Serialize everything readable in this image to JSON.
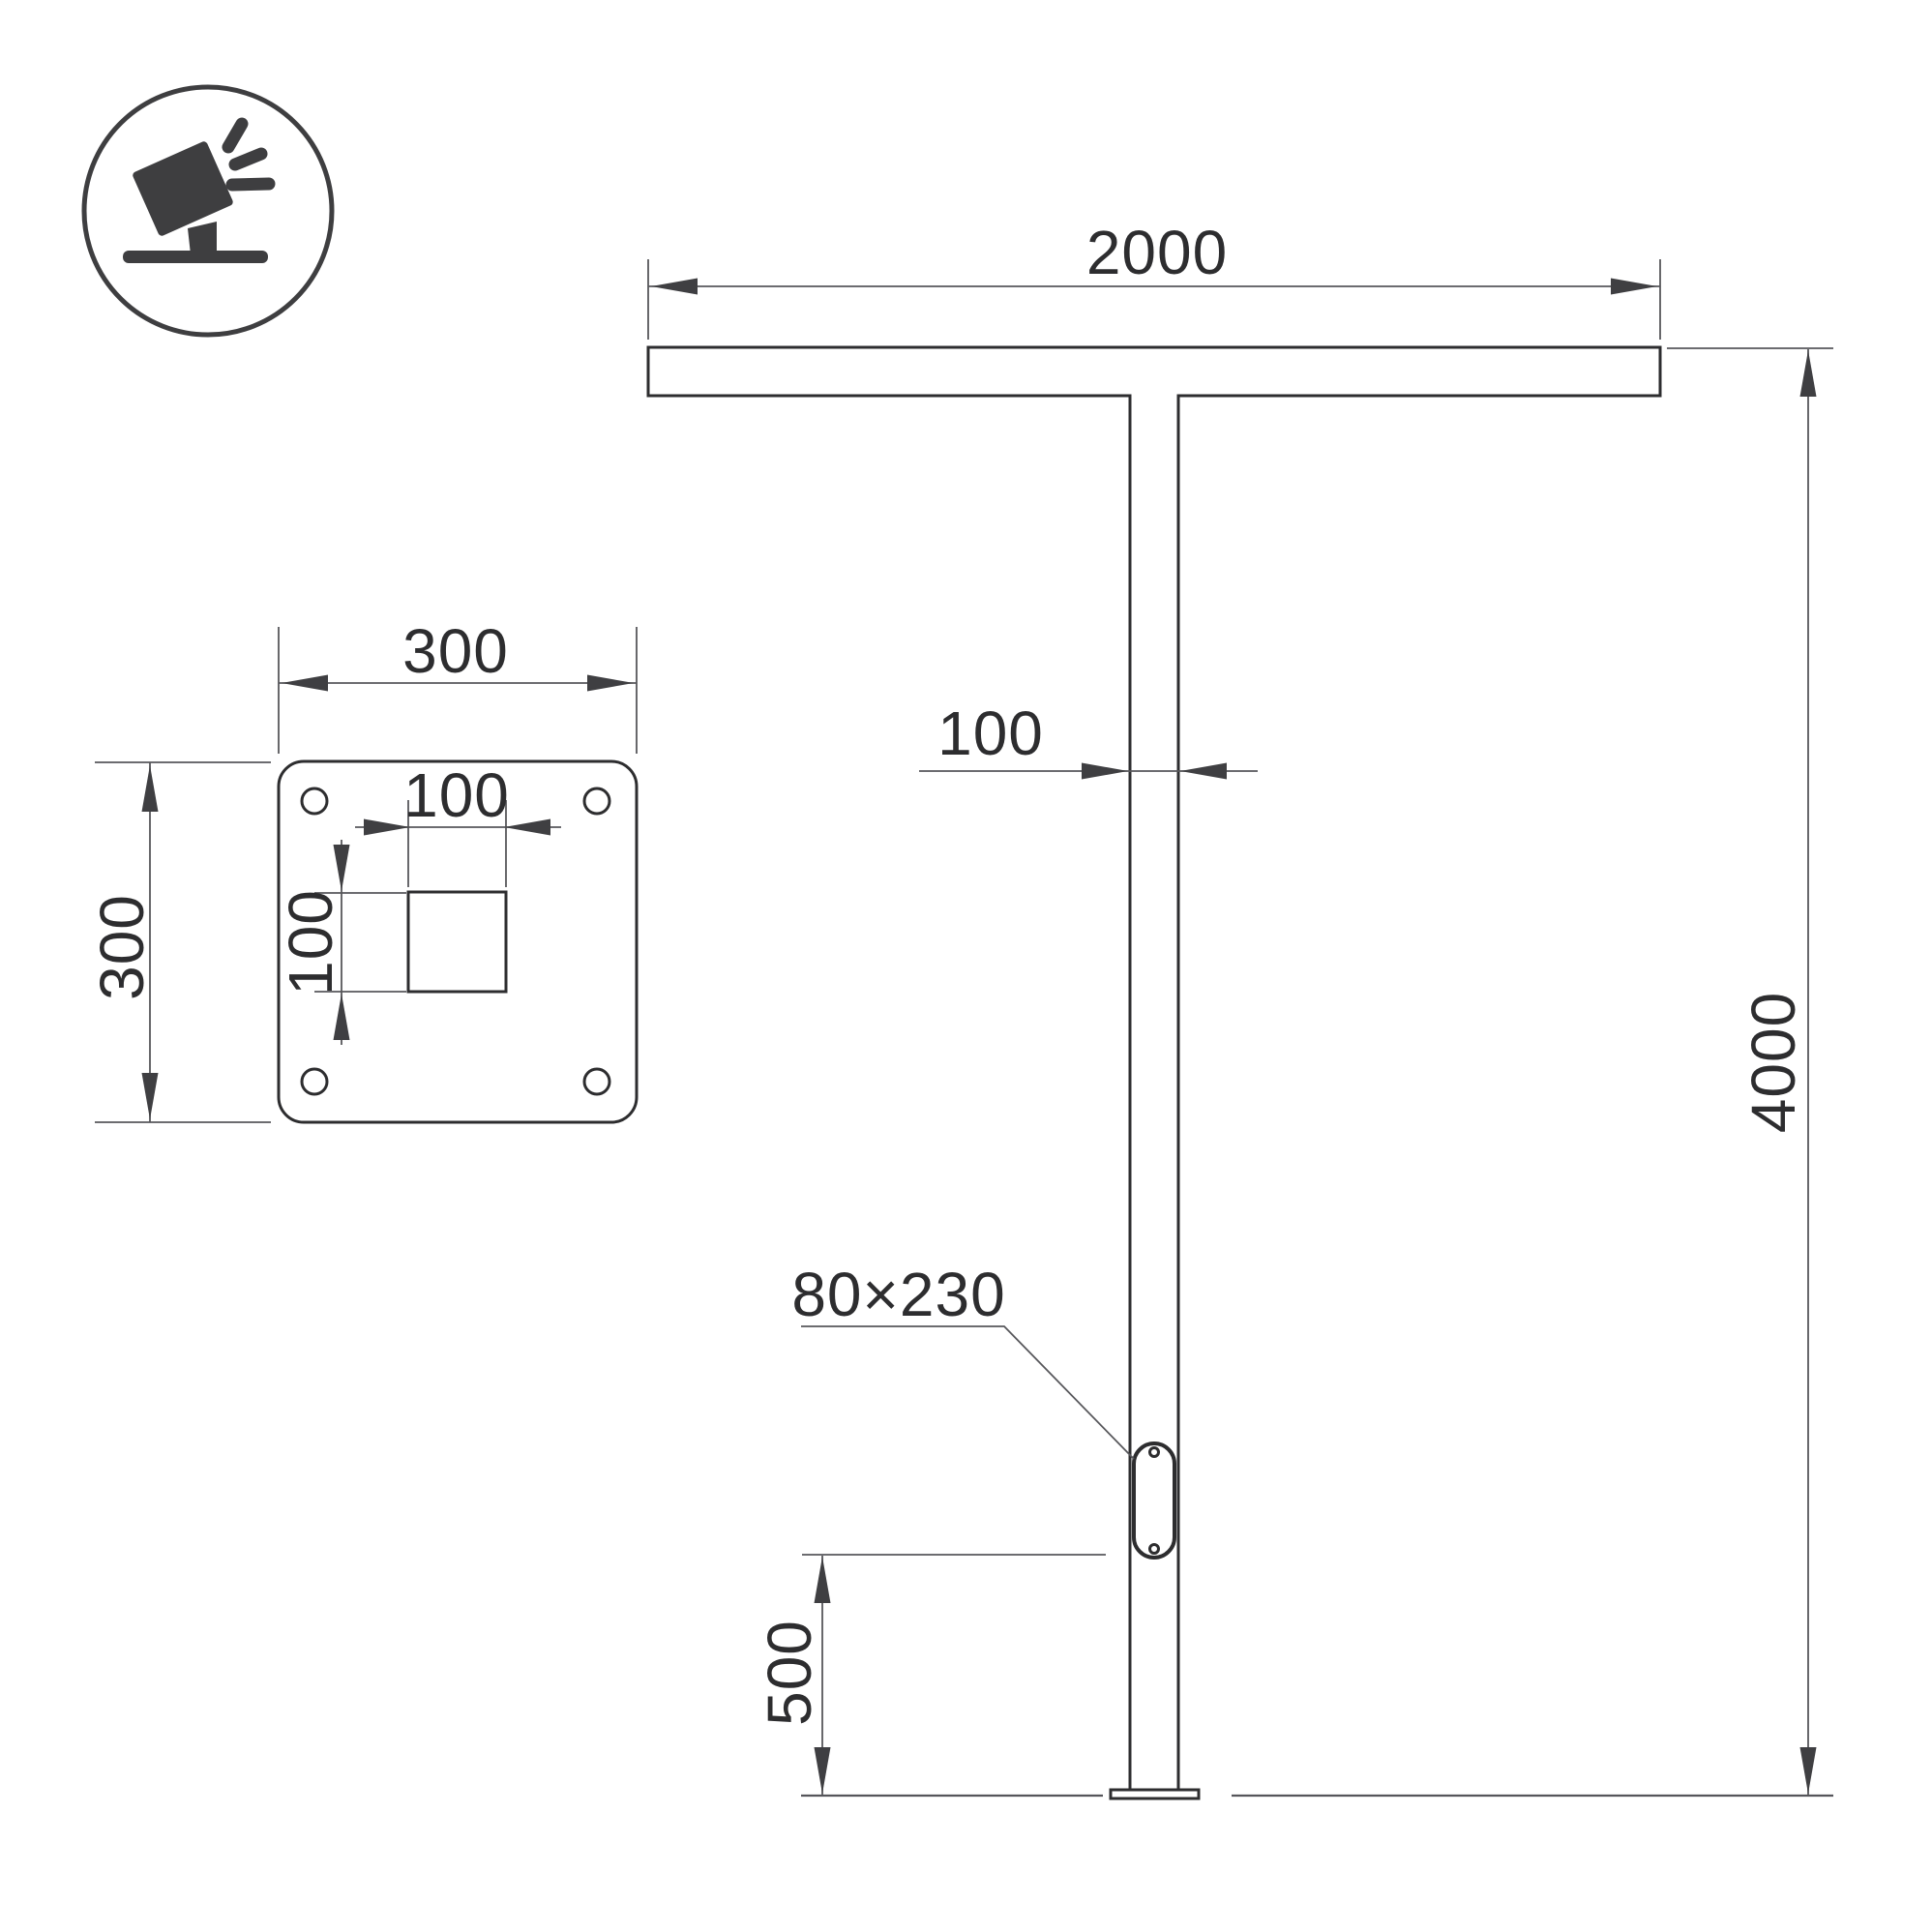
{
  "meta": {
    "kind": "technical-dimension-drawing",
    "subject": "T-shaped street light pole with mounting base plate"
  },
  "colors": {
    "background": "#ffffff",
    "object_line": "#2d2d2f",
    "dimension_line": "#57575b",
    "arrow": "#3f3f42",
    "text": "#2d2d2f",
    "icon": "#3e3e40"
  },
  "icon": {
    "name": "floodlight-icon",
    "description": "tilted floodlight luminaire above ground symbol in circle"
  },
  "front": {
    "arm_width": "2000",
    "pole_width": "100",
    "total_height": "4000",
    "door_size_label": "80×230",
    "door_height_from_base": "500"
  },
  "plate": {
    "width": "300",
    "height": "300",
    "socket_width": "100",
    "socket_height": "100"
  }
}
